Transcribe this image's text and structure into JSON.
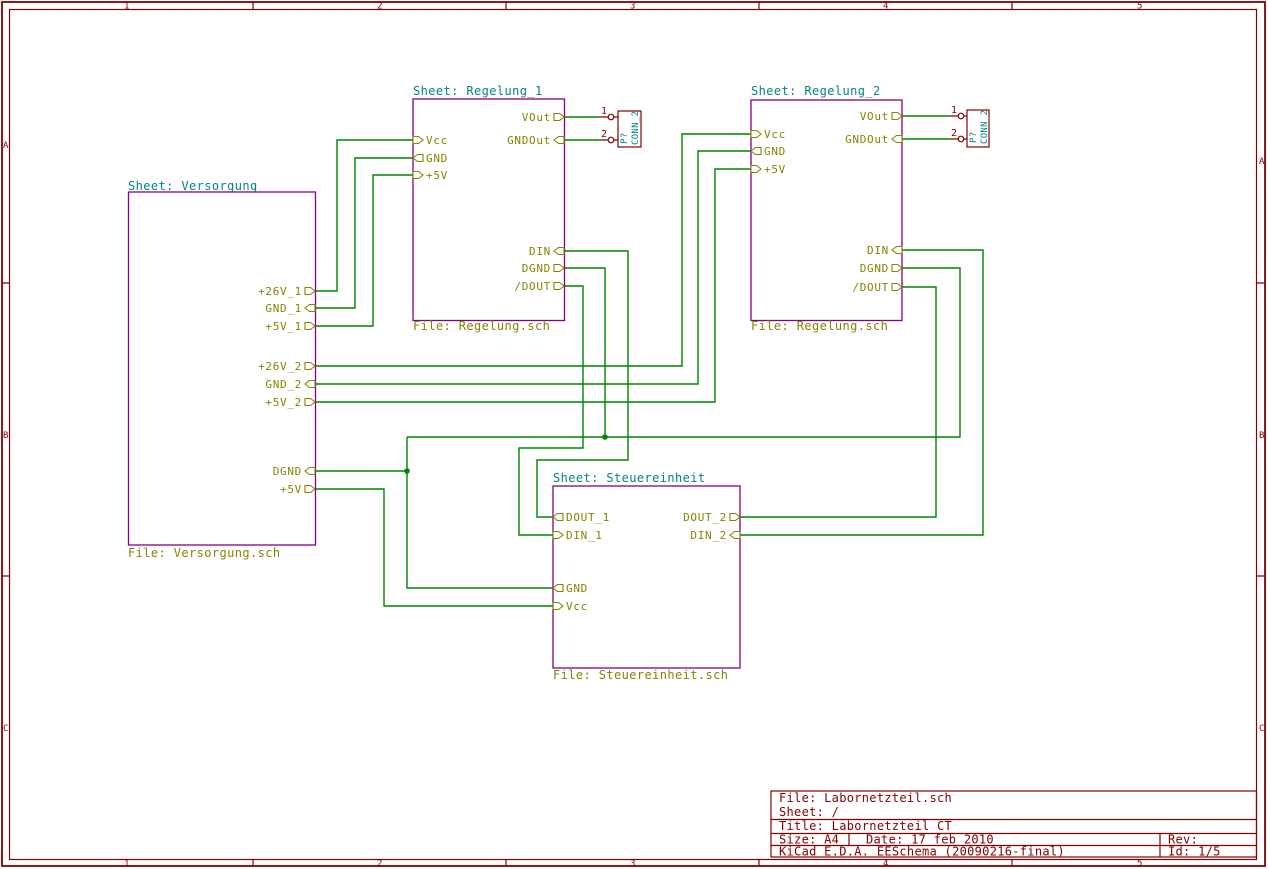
{
  "app": "EESchema schematic canvas",
  "colors": {
    "background": "#ffffff",
    "border": "#840000",
    "wire": "#008400",
    "sheet_outline": "#840084",
    "sheet_name_text": "#008484",
    "file_label_text": "#848400",
    "pin_label_text": "#848400",
    "component": "#840000",
    "component_value_text": "#008484"
  },
  "border": {
    "columns": [
      "1",
      "2",
      "3",
      "4",
      "5"
    ],
    "rows": [
      "A",
      "B",
      "C"
    ]
  },
  "sheets": [
    {
      "name_label": "Sheet: Versorgung",
      "file_label": "File: Versorgung.sch",
      "pins": {
        "right": [
          "+26V_1",
          "GND_1",
          "+5V_1",
          "+26V_2",
          "GND_2",
          "+5V_2",
          "DGND",
          "+5V"
        ]
      }
    },
    {
      "name_label": "Sheet: Regelung_1",
      "file_label": "File: Regelung.sch",
      "pins": {
        "left": [
          "Vcc",
          "GND",
          "+5V"
        ],
        "right": [
          "VOut",
          "GNDOut",
          "DIN",
          "DGND",
          "/DOUT"
        ]
      }
    },
    {
      "name_label": "Sheet: Regelung_2",
      "file_label": "File: Regelung.sch",
      "pins": {
        "left": [
          "Vcc",
          "GND",
          "+5V"
        ],
        "right": [
          "VOut",
          "GNDOut",
          "DIN",
          "DGND",
          "/DOUT"
        ]
      }
    },
    {
      "name_label": "Sheet: Steuereinheit",
      "file_label": "File: Steuereinheit.sch",
      "pins": {
        "left": [
          "DOUT_1",
          "DIN_1",
          "GND",
          "Vcc"
        ],
        "right": [
          "DOUT_2",
          "DIN_2"
        ]
      }
    }
  ],
  "connectors": [
    {
      "ref": "P?",
      "value": "CONN_2",
      "pin_numbers": [
        "1",
        "2"
      ]
    },
    {
      "ref": "P?",
      "value": "CONN_2",
      "pin_numbers": [
        "1",
        "2"
      ]
    }
  ],
  "title_block": {
    "file": "File: Labornetzteil.sch",
    "sheet": "Sheet: /",
    "title": "Title: Labornetzteil CT",
    "size": "Size: A4",
    "date": "Date: 17 feb 2010",
    "rev": "Rev:",
    "generator": "KiCad E.D.A.  EESchema (20090216-final)",
    "id": "Id: 1/5"
  }
}
